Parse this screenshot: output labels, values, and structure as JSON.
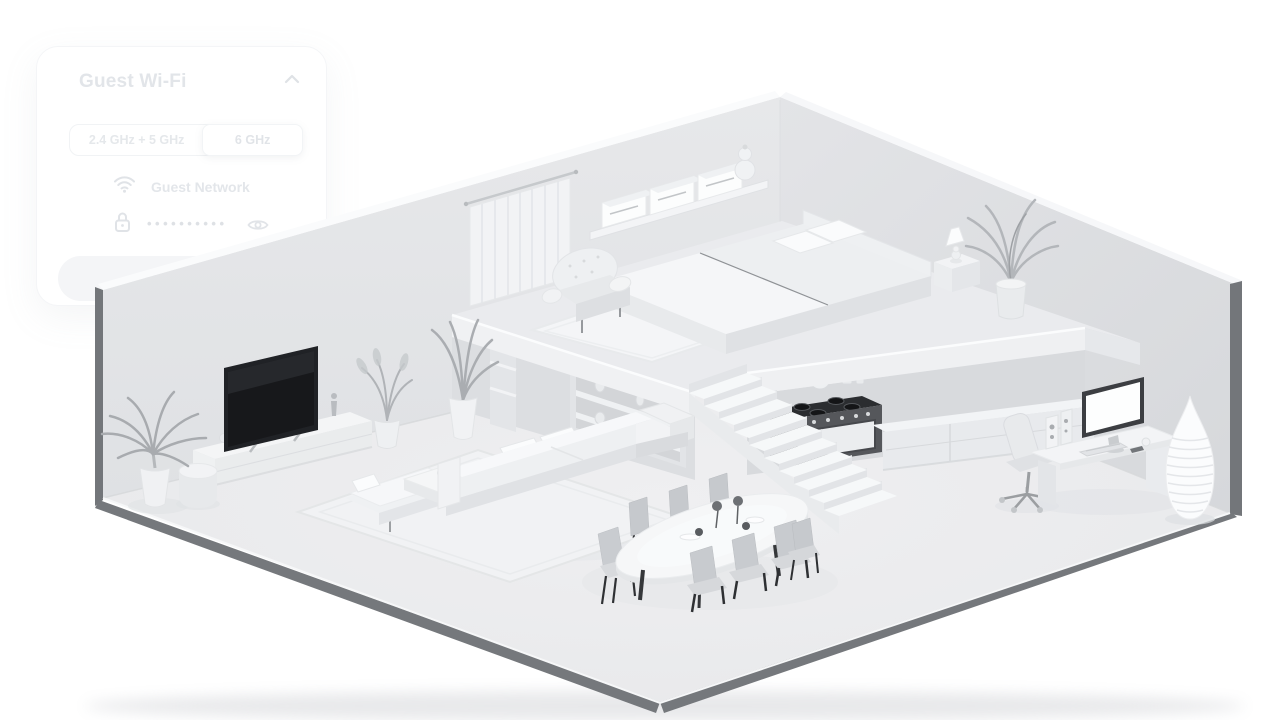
{
  "wifi_card": {
    "title": "Guest Wi-Fi",
    "band_options": [
      {
        "label": "2.4 GHz + 5 GHz",
        "selected": false
      },
      {
        "label": "6 GHz",
        "selected": true
      }
    ],
    "network": {
      "label": "Guest Network"
    },
    "password": {
      "masked_value": "••••••••••"
    },
    "share_button_label": "Share Wi-Fi"
  },
  "scene": {
    "alt": "Grayscale isometric 3D cutaway of a loft apartment: bedroom mezzanine with bed, armchair, curtains and shelf; living room with TV, media console, sofa and plants; kitchen with stove and cabinets under the loft; staircase; oval dining table with eight chairs; home office desk with monitor, office chair and a tall ribbed floor vase"
  },
  "colors": {
    "card_text": "#e2e5e9",
    "wall_edge": "#75787c",
    "tv_screen": "#1f2124",
    "floor": "#ecedef"
  }
}
